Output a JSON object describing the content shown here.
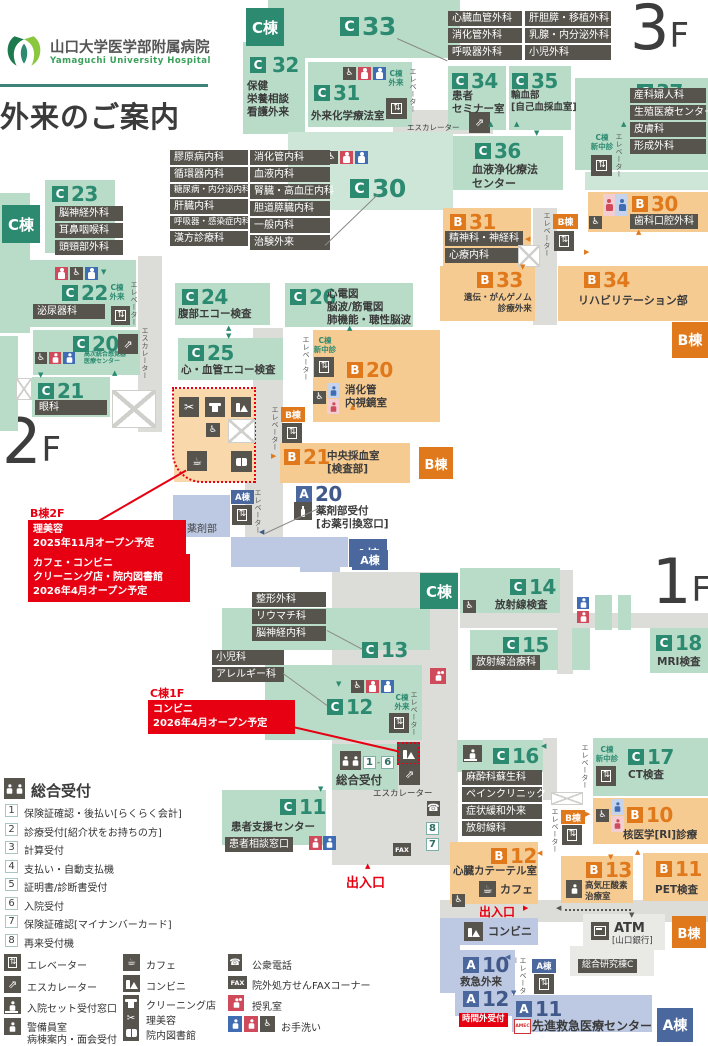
{
  "codes": {
    "c": "C",
    "b": "B",
    "a": "A"
  },
  "wings": {
    "c": "C棟",
    "b": "B棟",
    "a": "A棟"
  },
  "header": {
    "name_jp": "山口大学医学部附属病院",
    "name_en": "Yamaguchi University Hospital",
    "title": "外来のご案内"
  },
  "floors": {
    "f3": "3",
    "f2": "2",
    "f1": "1",
    "suffix": "F"
  },
  "common": {
    "elevator": "エレベーター",
    "escalator": "エスカレーター",
    "c_outpatient": [
      "C棟",
      "外来"
    ],
    "c_shinchushin": [
      "C棟",
      "新中診"
    ],
    "entrance": "出入口",
    "dash": "-"
  },
  "f3": {
    "c33": {
      "n": "33"
    },
    "c33_depts_col1": [
      "心臓血管外科",
      "消化管外科",
      "呼吸器外科"
    ],
    "c33_depts_col2": [
      "肝胆膵・移植外科",
      "乳腺・内分泌外科",
      "小児外科"
    ],
    "c32": {
      "n": "32",
      "lines": [
        "保健",
        "栄養相談",
        "看護外来"
      ]
    },
    "c31": {
      "n": "31",
      "name": "外来化学療法室"
    },
    "c30": {
      "n": "30"
    },
    "c30_depts_col1": [
      "膠原病内科",
      "循環器内科",
      "糖尿病・内分泌内科",
      "肝臓内科",
      "呼吸器・感染症内科",
      "漢方診療科"
    ],
    "c30_depts_col2": [
      "消化管内科",
      "血液内科",
      "腎臓・高血圧内科",
      "胆道膵臓内科",
      "一般内科",
      "治験外来"
    ],
    "c34": {
      "n": "34",
      "lines": [
        "患者",
        "セミナー室"
      ]
    },
    "c35": {
      "n": "35",
      "lines": [
        "輸血部",
        "[自己血採血室]"
      ]
    },
    "c36": {
      "n": "36",
      "lines": [
        "血液浄化療法",
        "センター"
      ]
    },
    "c37": {
      "n": "37",
      "depts": [
        "産科婦人科",
        "生殖医療センター",
        "皮膚科",
        "形成外科"
      ]
    },
    "b30": {
      "n": "30",
      "name": "歯科口腔外科"
    },
    "b31": {
      "n": "31",
      "depts": [
        "精神科・神経科",
        "心療内科"
      ]
    },
    "b33": {
      "n": "33",
      "lines": [
        "遺伝・がんゲノム",
        "診療外来"
      ]
    },
    "b34": {
      "n": "34",
      "name": "リハビリテーション部"
    }
  },
  "f2": {
    "c23": {
      "n": "23",
      "depts": [
        "脳神経外科",
        "耳鼻咽喉科",
        "頭頸部外科"
      ]
    },
    "c22": {
      "n": "22",
      "name": "泌尿器科"
    },
    "c20": {
      "n": "20",
      "lines": [
        "高次統合感覚器",
        "医療センター"
      ]
    },
    "c21": {
      "n": "21",
      "name": "眼科"
    },
    "c24": {
      "n": "24",
      "name": "腹部エコー検査"
    },
    "c25": {
      "n": "25",
      "name": "心・血管エコー検査"
    },
    "c26": {
      "n": "26",
      "lines": [
        "心電図",
        "脳波/筋電図",
        "肺機能・聴性脳波"
      ]
    },
    "b20": {
      "n": "20",
      "lines": [
        "消化管",
        "内視鏡室"
      ]
    },
    "b21": {
      "n": "21",
      "lines": [
        "中央採血室",
        "[検査部]"
      ]
    },
    "a20": {
      "n": "20",
      "lines": [
        "薬剤部受付",
        "[お薬引換窓口]"
      ]
    },
    "pharmacy": "薬剤部",
    "note": {
      "head": "B棟2F",
      "box1": [
        "理美容",
        "2025年11月オープン予定"
      ],
      "box2": [
        "カフェ・コンビニ",
        "クリーニング店・院内図書館",
        "2026年4月オープン予定"
      ]
    }
  },
  "f1": {
    "c14": {
      "n": "14",
      "name": "放射線検査"
    },
    "c15": {
      "n": "15",
      "name": "放射線治療科"
    },
    "c18": {
      "n": "18",
      "name": "MRI検査"
    },
    "c13": {
      "n": "13",
      "depts": [
        "整形外科",
        "リウマチ科",
        "脳神経内科"
      ]
    },
    "c12": {
      "n": "12",
      "depts": [
        "小児科",
        "アレルギー科"
      ]
    },
    "c16": {
      "n": "16",
      "depts": [
        "麻酔科蘇生科",
        "ペインクリニック",
        "症状緩和外来",
        "放射線科"
      ]
    },
    "c17": {
      "n": "17",
      "name": "CT検査"
    },
    "c11": {
      "n": "11",
      "name": "患者支援センター",
      "window": "患者相談窓口"
    },
    "b10": {
      "n": "10",
      "name": "核医学[RI]診療"
    },
    "b12": {
      "n": "12",
      "name": "心臓カテーテル室",
      "cafe": "カフェ"
    },
    "b13": {
      "n": "13",
      "lines": [
        "高気圧酸素",
        "治療室"
      ]
    },
    "b11": {
      "n": "11",
      "name": "PET検査"
    },
    "a10": {
      "n": "10",
      "name": "救急外来"
    },
    "a12": {
      "n": "12",
      "name": "時間外受付"
    },
    "a11": {
      "n": "11",
      "name": "先進救急医療センター",
      "logo": "AMEC"
    },
    "reception": {
      "title": "総合受付",
      "from": "1",
      "to": "6"
    },
    "counters": {
      "n8": "8",
      "n7": "7"
    },
    "fax": "FAX",
    "conv": "コンビニ",
    "atm": {
      "name": "ATM",
      "bank": "[山口銀行]"
    },
    "lab": "総合研究棟C",
    "note": {
      "head": "C棟1F",
      "box": [
        "コンビニ",
        "2026年4月オープン予定"
      ]
    }
  },
  "legend": {
    "reception": {
      "title": "総合受付",
      "items": [
        {
          "n": "1",
          "t": "保険証確認・後払い[らくらく会計]"
        },
        {
          "n": "2",
          "t": "診療受付[紹介状をお持ちの方]"
        },
        {
          "n": "3",
          "t": "計算受付"
        },
        {
          "n": "4",
          "t": "支払い・自動支払機"
        },
        {
          "n": "5",
          "t": "証明書/診断書受付"
        },
        {
          "n": "6",
          "t": "入院受付"
        },
        {
          "n": "7",
          "t": "保険証確認[マイナンバーカード]"
        },
        {
          "n": "8",
          "t": "再来受付機"
        }
      ]
    },
    "col1": [
      {
        "t": "エレベーター"
      },
      {
        "t": "エスカレーター"
      },
      {
        "t": "入院セット受付窓口"
      },
      {
        "t": "警備員室",
        "t2": "病棟案内・面会受付"
      }
    ],
    "col2": [
      {
        "t": "カフェ"
      },
      {
        "t": "コンビニ"
      },
      {
        "t": "クリーニング店"
      },
      {
        "t": "理美容"
      },
      {
        "t": "院内図書館"
      }
    ],
    "col3": [
      {
        "t": "公衆電話"
      },
      {
        "t": "院外処方せんFAXコーナー"
      },
      {
        "t": "授乳室"
      },
      {
        "t": "お手洗い"
      }
    ]
  },
  "colors": {
    "c_green": "#2c8a71",
    "b_orange": "#e0791c",
    "a_blue": "#4a689e",
    "red": "#e60012",
    "male": "#3f6cb3",
    "female": "#cf4a5a",
    "dark": "#57544e"
  }
}
